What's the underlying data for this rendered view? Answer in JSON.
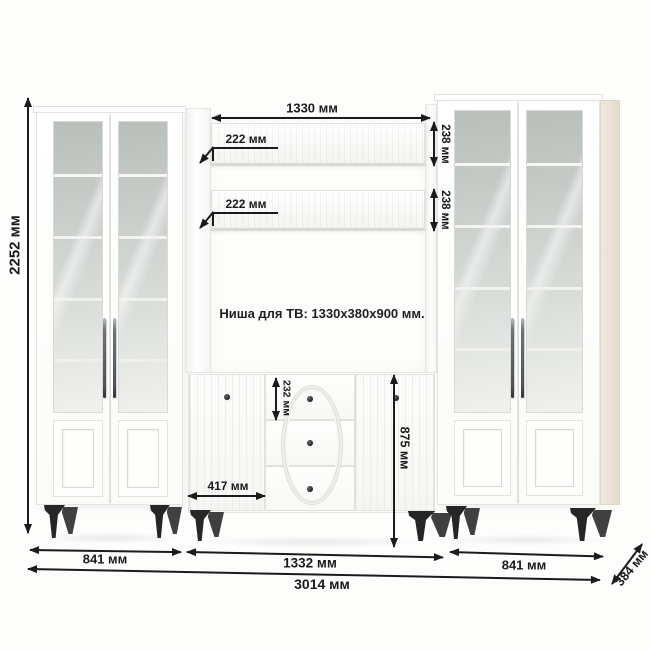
{
  "diagram_type": "furniture-dimension-drawing",
  "note": {
    "tv_niche": "Ниша для ТВ: 1330x380x900 мм."
  },
  "dims": {
    "total_height": "2252 мм",
    "niche_width": "1330 мм",
    "shelf_depth_upper": "222 мм",
    "shelf_depth_lower": "222 мм",
    "shelf_front_upper": "238 мм",
    "shelf_front_lower": "238 мм",
    "top_drawer_height": "232 мм",
    "chest_door_width": "417 мм",
    "chest_height": "875 мм",
    "left_cabinet_width": "841 мм",
    "center_section_width": "1332 мм",
    "right_cabinet_width": "841 мм",
    "total_width": "3014 мм",
    "depth": "384 мм"
  },
  "colors": {
    "background": "#fdfdfc",
    "furniture_body": "#ffffff",
    "glass": "#c9cec9",
    "side_panel": "#e9e3d5",
    "legs": "#2a2a2a",
    "dimension_lines": "#1b1b1b"
  }
}
